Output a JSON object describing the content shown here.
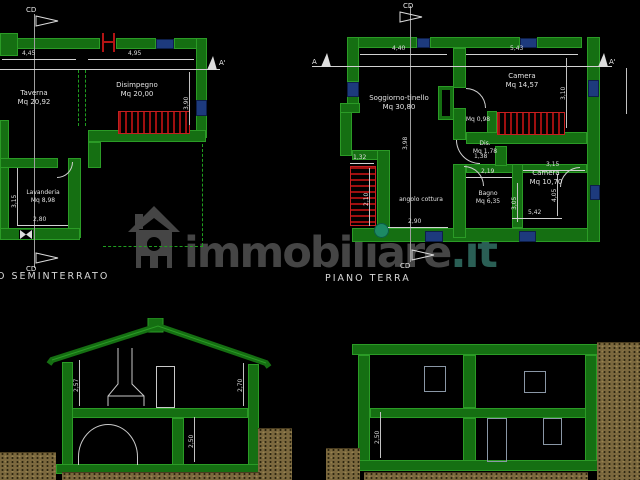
{
  "colors": {
    "background": "#000000",
    "wall_green": "#156f12",
    "stair_red": "#9e0f0f",
    "window_blue": "#1d3a7d",
    "dim_white": "#dedede",
    "ground_brown": "#7b683e",
    "watermark_gray": "#454545",
    "watermark_teal": "#2a5f55",
    "bush_teal": "#1c8a64"
  },
  "watermark": {
    "brand": "immobiliare",
    "tld": ".it"
  },
  "plan_seminterrato": {
    "floor_label": "O SEMINTERRATO",
    "marker_cd_top": "CD",
    "marker_cd_bottom": "CD",
    "marker_a_end": "A'",
    "rooms": {
      "taverna": {
        "name": "Taverna",
        "area": "Mq 20,92"
      },
      "disimpegno": {
        "name": "Disimpegno",
        "area": "Mq 20,00"
      },
      "lavanderia": {
        "name": "Lavanderia",
        "area": "Mq 8,98"
      }
    },
    "dims": {
      "taverna_width": "4,45",
      "disimpegno_width": "4,95",
      "disimpegno_height": "3,90",
      "lavanderia_height": "3,15",
      "lavanderia_width": "2,80"
    }
  },
  "plan_terra": {
    "floor_label": "PIANO TERRA",
    "marker_cd_top": "CD",
    "marker_cd_bottom": "CD",
    "marker_a_start": "A",
    "marker_a_end": "A'",
    "rooms": {
      "soggiorno": {
        "name": "Soggiorno-tinello",
        "area": "Mq 30,80"
      },
      "camera1": {
        "name": "Camera",
        "area": "Mq 14,57"
      },
      "ripostiglio": {
        "area": "Mq 0,98"
      },
      "dis": {
        "name": "Dis.",
        "area": "Mq 1,78"
      },
      "bagno": {
        "name": "Bagno",
        "area": "Mq 6,35"
      },
      "camera2": {
        "name": "Camera",
        "area": "Mq 10,70"
      },
      "cottura": {
        "name": "angolo cottura"
      }
    },
    "dims": {
      "soggiorno_width": "4,40",
      "camera1_width": "5,43",
      "camera1_height": "3,10",
      "stair_width": "1,32",
      "stair_height": "2,10",
      "dis_width": "1,38",
      "bagno_width": "2,19",
      "bagno_height": "3,05",
      "camera2_width_top": "3,15",
      "camera2_height": "4,05",
      "camera2_width_bottom": "5,42",
      "cottura_width": "2,90",
      "mid_height": "3,98"
    }
  },
  "section_left": {
    "dims": {
      "floor_left": "2,57",
      "floor_right": "2,70",
      "basement": "2,50"
    }
  },
  "section_right": {
    "dims": {
      "ground_floor": "2,50"
    }
  }
}
